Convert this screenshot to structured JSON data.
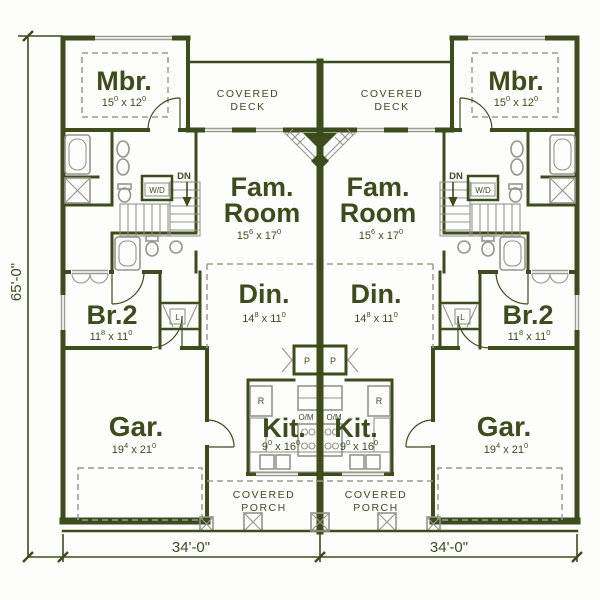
{
  "plan": {
    "type": "duplex-floor-plan",
    "colors": {
      "wall": "#3c4c1d",
      "fixture": "#94958b",
      "background": "#fdfdfb"
    },
    "dimensions": {
      "left_total": "65'-0\"",
      "bottom_left_unit": "34'-0\"",
      "bottom_right_unit": "34'-0\""
    },
    "rooms": {
      "mbr": {
        "label": "Mbr.",
        "dim": {
          "a": "15",
          "asup": "0",
          "b": " x 12",
          "bsup": "0"
        }
      },
      "fam": {
        "line1": "Fam.",
        "line2": "Room",
        "dim": {
          "a": "15",
          "asup": "6",
          "b": " x 17",
          "bsup": "0"
        }
      },
      "din": {
        "label": "Din.",
        "dim": {
          "a": "14",
          "asup": "8",
          "b": " x 11",
          "bsup": "0"
        }
      },
      "br2": {
        "label": "Br.2",
        "dim": {
          "a": "11",
          "asup": "8",
          "b": " x 11",
          "bsup": "0"
        }
      },
      "gar": {
        "label": "Gar.",
        "dim": {
          "a": "19",
          "asup": "4",
          "b": " x 21",
          "bsup": "0"
        }
      },
      "kit": {
        "label": "Kit.",
        "dim": {
          "a": "9",
          "asup": "0",
          "b": " x 16",
          "bsup": "0"
        }
      },
      "deck": {
        "line1": "COVERED",
        "line2": "DECK"
      },
      "porch": {
        "line1": "COVERED",
        "line2": "PORCH"
      }
    },
    "annotations": {
      "washer_dryer": "W/D",
      "stairs_down": "DN",
      "linen": "L",
      "refrigerator": "R",
      "pantry": "P",
      "oven_microwave": "O/M"
    }
  }
}
